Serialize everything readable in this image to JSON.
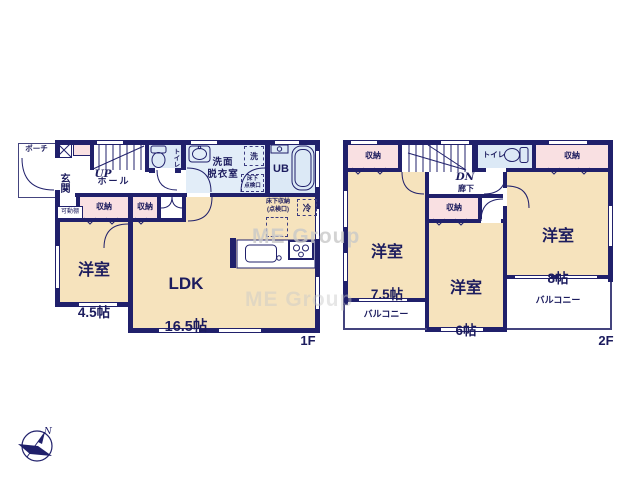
{
  "watermark": "ME Group",
  "compass": {
    "north": "N"
  },
  "f1": {
    "floor_label": "1F",
    "porch": "ポーチ",
    "entrance": "玄関",
    "movable_shelf": "可動棚",
    "stairs_up": "UP",
    "hall": "ホール",
    "toilet": "トイレ",
    "washroom": "洗面\n脱衣室",
    "washer": "洗",
    "underfloor_access": "床下\n点検口",
    "bath": "UB",
    "storage_a": "収納",
    "storage_b": "収納",
    "western_room": {
      "name": "洋室",
      "size": "4.5帖"
    },
    "ldk": {
      "name": "LDK",
      "size": "16.5帖"
    },
    "underfloor_storage": "床下収納\n(点検口)",
    "fridge": "冷"
  },
  "f2": {
    "floor_label": "2F",
    "storage_left": "収納",
    "stairs_down": "DN",
    "corridor": "廊下",
    "toilet": "トイレ",
    "storage_right": "収納",
    "storage_mid": "収納",
    "room_75": {
      "name": "洋室",
      "size": "7.5帖"
    },
    "room_6": {
      "name": "洋室",
      "size": "6帖"
    },
    "room_8": {
      "name": "洋室",
      "size": "8帖"
    },
    "balcony_left": "バルコニー",
    "balcony_right": "バルコニー"
  }
}
